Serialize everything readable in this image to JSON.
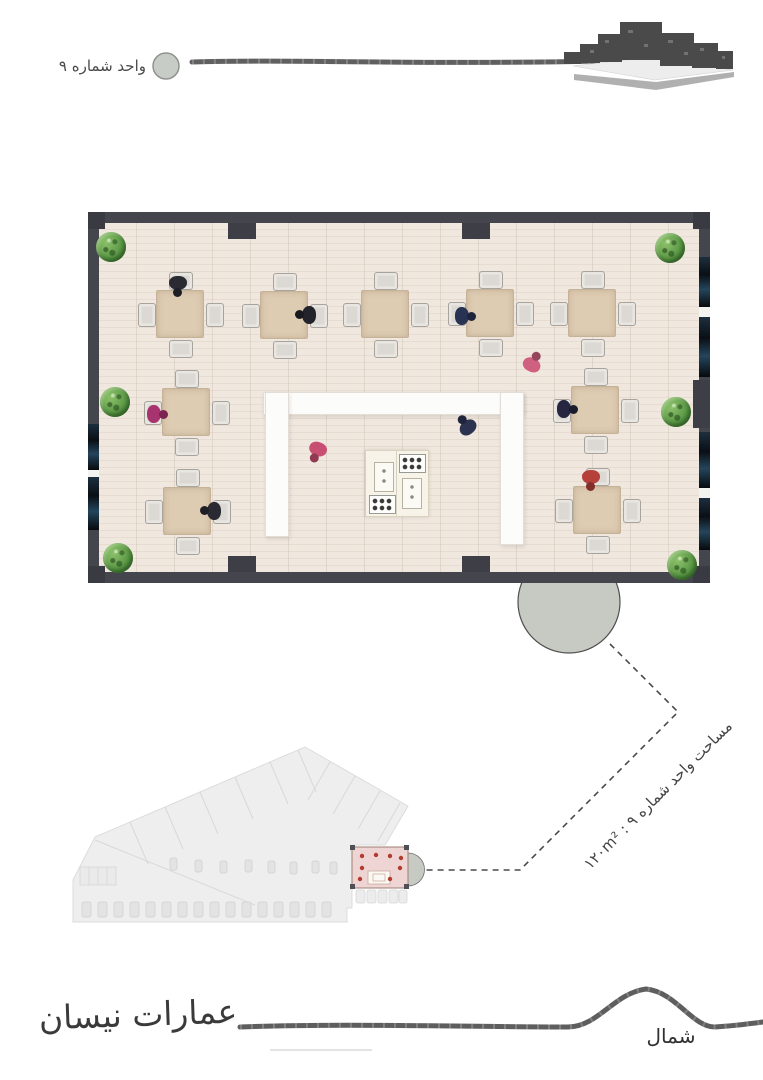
{
  "header": {
    "unit_label": "واحد شماره ۹"
  },
  "callout": {
    "area_label": "مساحت واحد شماره ۹ : ۱۲۰m²"
  },
  "footer": {
    "north_label": "شمال",
    "signature": "عمارات نیسان"
  },
  "colors": {
    "wall": "#45454e",
    "floor": "#efe5dc",
    "floor_stripe": "#e7dcd1",
    "table": "#ddcbb2",
    "chair": "#dcd9d4",
    "counter_white": "#fcfcfa",
    "window_glass": "#16222e",
    "plant_green": "#5d9a47",
    "entrance_marker_gray": "#c6cac3",
    "site_plan_gray": "#eeeeee",
    "highlight_unit_pink": "#eed5d3",
    "highlight_dots_red": "#b23a31",
    "sketch_line": "#5e5e5e",
    "text": "#3c3c3c"
  },
  "floor_plan": {
    "tables": [
      {
        "x": 92,
        "y": 102
      },
      {
        "x": 196,
        "y": 103
      },
      {
        "x": 297,
        "y": 102
      },
      {
        "x": 402,
        "y": 101
      },
      {
        "x": 504,
        "y": 101
      },
      {
        "x": 98,
        "y": 200
      },
      {
        "x": 507,
        "y": 198
      },
      {
        "x": 99,
        "y": 299
      },
      {
        "x": 509,
        "y": 298
      }
    ],
    "plants": [
      {
        "x": 23,
        "y": 35
      },
      {
        "x": 27,
        "y": 190
      },
      {
        "x": 30,
        "y": 346
      },
      {
        "x": 582,
        "y": 36
      },
      {
        "x": 588,
        "y": 200
      },
      {
        "x": 594,
        "y": 353
      }
    ],
    "people": [
      {
        "x": 90,
        "y": 74,
        "rot": 180,
        "color": "#2a2a33"
      },
      {
        "x": 218,
        "y": 103,
        "rot": 270,
        "color": "#23232c"
      },
      {
        "x": 377,
        "y": 104,
        "rot": 90,
        "color": "#283252"
      },
      {
        "x": 445,
        "y": 150,
        "rot": 25,
        "color": "#cf6080"
      },
      {
        "x": 69,
        "y": 202,
        "rot": 90,
        "color": "#a8346f"
      },
      {
        "x": 479,
        "y": 197,
        "rot": 90,
        "color": "#262640"
      },
      {
        "x": 123,
        "y": 299,
        "rot": 270,
        "color": "#2a2a33"
      },
      {
        "x": 503,
        "y": 268,
        "rot": 180,
        "color": "#b5413a"
      },
      {
        "x": 229,
        "y": 240,
        "rot": 200,
        "color": "#c94f72"
      },
      {
        "x": 378,
        "y": 213,
        "rot": 320,
        "color": "#2b3350"
      }
    ]
  }
}
